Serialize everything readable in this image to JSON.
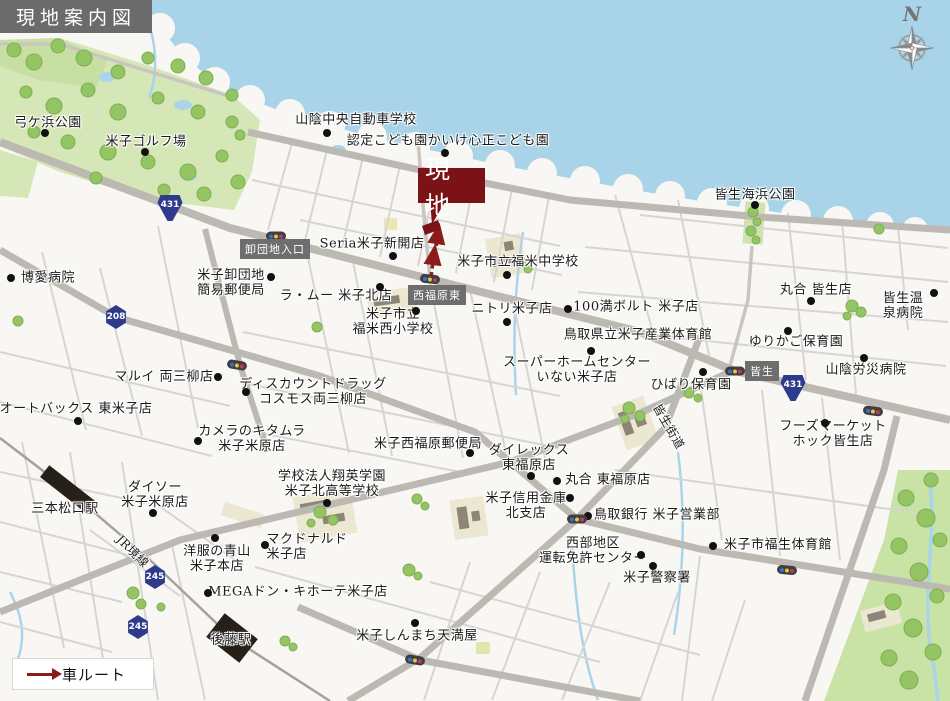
{
  "title": "現地案内図",
  "legend": {
    "route_label": "車ルート"
  },
  "compass": {
    "north_label": "N"
  },
  "site_marker": {
    "label": "現地"
  },
  "colors": {
    "accent_maroon": "#7a1216",
    "route_red": "#8b1c1c",
    "shield_blue": "#2e3a8c",
    "sea": "#a9d3e8",
    "park_green": "#d5e7b6",
    "road_gray": "#bcb8b2",
    "signbox_gray": "#6e6e6e"
  },
  "map": {
    "road_sign_boxes": [
      {
        "label": "卸団地入口",
        "x": 275,
        "y": 249
      },
      {
        "label": "西福原東",
        "x": 437,
        "y": 295
      },
      {
        "label": "皆生",
        "x": 762,
        "y": 371
      }
    ],
    "route_shields": [
      {
        "number": "431",
        "x": 170,
        "y": 208,
        "kind": "nat"
      },
      {
        "number": "431",
        "x": 793,
        "y": 388,
        "kind": "nat"
      },
      {
        "number": "208",
        "x": 116,
        "y": 317,
        "kind": "pref"
      },
      {
        "number": "245",
        "x": 155,
        "y": 577,
        "kind": "pref"
      },
      {
        "number": "245",
        "x": 138,
        "y": 627,
        "kind": "pref"
      }
    ],
    "labels": [
      {
        "t": "弓ケ浜公園",
        "x": 48,
        "y": 124
      },
      {
        "t": "米子ゴルフ場",
        "x": 146,
        "y": 143
      },
      {
        "t": "山陰中央自動車学校",
        "x": 356,
        "y": 121
      },
      {
        "t": "認定こども園かいけ心正こども園",
        "x": 448,
        "y": 142
      },
      {
        "t": "皆生海浜公園",
        "x": 755,
        "y": 196
      },
      {
        "t": "Seria米子新開店",
        "x": 372,
        "y": 245
      },
      {
        "t": "米子市立福米中学校",
        "x": 518,
        "y": 263
      },
      {
        "t": "ラ・ムー 米子北店",
        "x": 336,
        "y": 297
      },
      {
        "t": "米子卸団地\n簡易郵便局",
        "x": 231,
        "y": 284
      },
      {
        "t": "博愛病院",
        "x": 48,
        "y": 279
      },
      {
        "t": "米子市立\n福米西小学校",
        "x": 393,
        "y": 323
      },
      {
        "t": "ニトリ米子店",
        "x": 512,
        "y": 310
      },
      {
        "t": "100満ボルト 米子店",
        "x": 636,
        "y": 308
      },
      {
        "t": "鳥取県立米子産業体育館",
        "x": 638,
        "y": 336
      },
      {
        "t": "スーパーホームセンター\nいない米子店",
        "x": 577,
        "y": 371
      },
      {
        "t": "ひばり保育園",
        "x": 691,
        "y": 386
      },
      {
        "t": "ゆりかご保育園",
        "x": 796,
        "y": 343
      },
      {
        "t": "丸合 皆生店",
        "x": 816,
        "y": 291
      },
      {
        "t": "皆生温泉病院",
        "x": 903,
        "y": 307
      },
      {
        "t": "山陰労災病院",
        "x": 866,
        "y": 371
      },
      {
        "t": "フーズマーケットホック皆生店",
        "x": 833,
        "y": 435
      },
      {
        "t": "マルイ 両三柳店",
        "x": 164,
        "y": 378
      },
      {
        "t": "ディスカウントドラッグ\nコスモス両三柳店",
        "x": 313,
        "y": 393
      },
      {
        "t": "オートバックス 東米子店",
        "x": 76,
        "y": 410
      },
      {
        "t": "カメラのキタムラ\n米子米原店",
        "x": 252,
        "y": 440
      },
      {
        "t": "ダイソー\n米子米原店",
        "x": 155,
        "y": 496
      },
      {
        "t": "三本松口駅",
        "x": 65,
        "y": 510
      },
      {
        "t": "JR境線",
        "x": 132,
        "y": 552,
        "rot": 45,
        "fs": 12
      },
      {
        "t": "学校法人翔英学園\n米子北高等学校",
        "x": 332,
        "y": 485
      },
      {
        "t": "マクドナルド\n米子店",
        "x": 307,
        "y": 548,
        "al": "left"
      },
      {
        "t": "洋服の青山\n米子本店",
        "x": 217,
        "y": 560
      },
      {
        "t": "MEGAドン・キホーテ米子店",
        "x": 298,
        "y": 593
      },
      {
        "t": "米子西福原郵便局",
        "x": 428,
        "y": 445
      },
      {
        "t": "ダイレックス\n東福原店",
        "x": 529,
        "y": 459
      },
      {
        "t": "丸合 東福原店",
        "x": 608,
        "y": 481
      },
      {
        "t": "米子信用金庫\n北支店",
        "x": 526,
        "y": 507
      },
      {
        "t": "鳥取銀行 米子営業部",
        "x": 657,
        "y": 516
      },
      {
        "t": "西部地区\n運転免許センター",
        "x": 593,
        "y": 552
      },
      {
        "t": "米子警察署",
        "x": 657,
        "y": 579
      },
      {
        "t": "米子市福生体育館",
        "x": 778,
        "y": 546
      },
      {
        "t": "米子しんまち天満屋",
        "x": 417,
        "y": 637
      },
      {
        "t": "後藤駅",
        "x": 231,
        "y": 641
      },
      {
        "t": "皆生街道",
        "x": 668,
        "y": 427,
        "rot": 60,
        "fs": 12
      }
    ],
    "poi_dots": [
      {
        "x": 45,
        "y": 133
      },
      {
        "x": 145,
        "y": 152
      },
      {
        "x": 327,
        "y": 133
      },
      {
        "x": 445,
        "y": 153
      },
      {
        "x": 393,
        "y": 256
      },
      {
        "x": 507,
        "y": 275
      },
      {
        "x": 380,
        "y": 287
      },
      {
        "x": 271,
        "y": 277
      },
      {
        "x": 11,
        "y": 278
      },
      {
        "x": 507,
        "y": 322
      },
      {
        "x": 568,
        "y": 309
      },
      {
        "x": 591,
        "y": 351
      },
      {
        "x": 703,
        "y": 372
      },
      {
        "x": 788,
        "y": 331
      },
      {
        "x": 811,
        "y": 301
      },
      {
        "x": 934,
        "y": 293
      },
      {
        "x": 864,
        "y": 358
      },
      {
        "x": 825,
        "y": 423
      },
      {
        "x": 218,
        "y": 377
      },
      {
        "x": 246,
        "y": 392
      },
      {
        "x": 78,
        "y": 421
      },
      {
        "x": 198,
        "y": 441
      },
      {
        "x": 153,
        "y": 513
      },
      {
        "x": 327,
        "y": 503
      },
      {
        "x": 265,
        "y": 545
      },
      {
        "x": 215,
        "y": 538
      },
      {
        "x": 208,
        "y": 593
      },
      {
        "x": 470,
        "y": 453
      },
      {
        "x": 531,
        "y": 476
      },
      {
        "x": 557,
        "y": 481
      },
      {
        "x": 570,
        "y": 498
      },
      {
        "x": 588,
        "y": 516
      },
      {
        "x": 641,
        "y": 555
      },
      {
        "x": 653,
        "y": 566
      },
      {
        "x": 713,
        "y": 546
      },
      {
        "x": 415,
        "y": 623
      },
      {
        "x": 755,
        "y": 205
      },
      {
        "x": 416,
        "y": 311
      }
    ],
    "traffic_lights": [
      {
        "x": 276,
        "y": 236,
        "rot": 0
      },
      {
        "x": 430,
        "y": 279,
        "rot": 6
      },
      {
        "x": 237,
        "y": 365,
        "rot": 10
      },
      {
        "x": 735,
        "y": 371,
        "rot": 0
      },
      {
        "x": 873,
        "y": 411,
        "rot": 8
      },
      {
        "x": 577,
        "y": 519,
        "rot": 0
      },
      {
        "x": 787,
        "y": 570,
        "rot": 5
      },
      {
        "x": 415,
        "y": 660,
        "rot": 10
      }
    ]
  }
}
